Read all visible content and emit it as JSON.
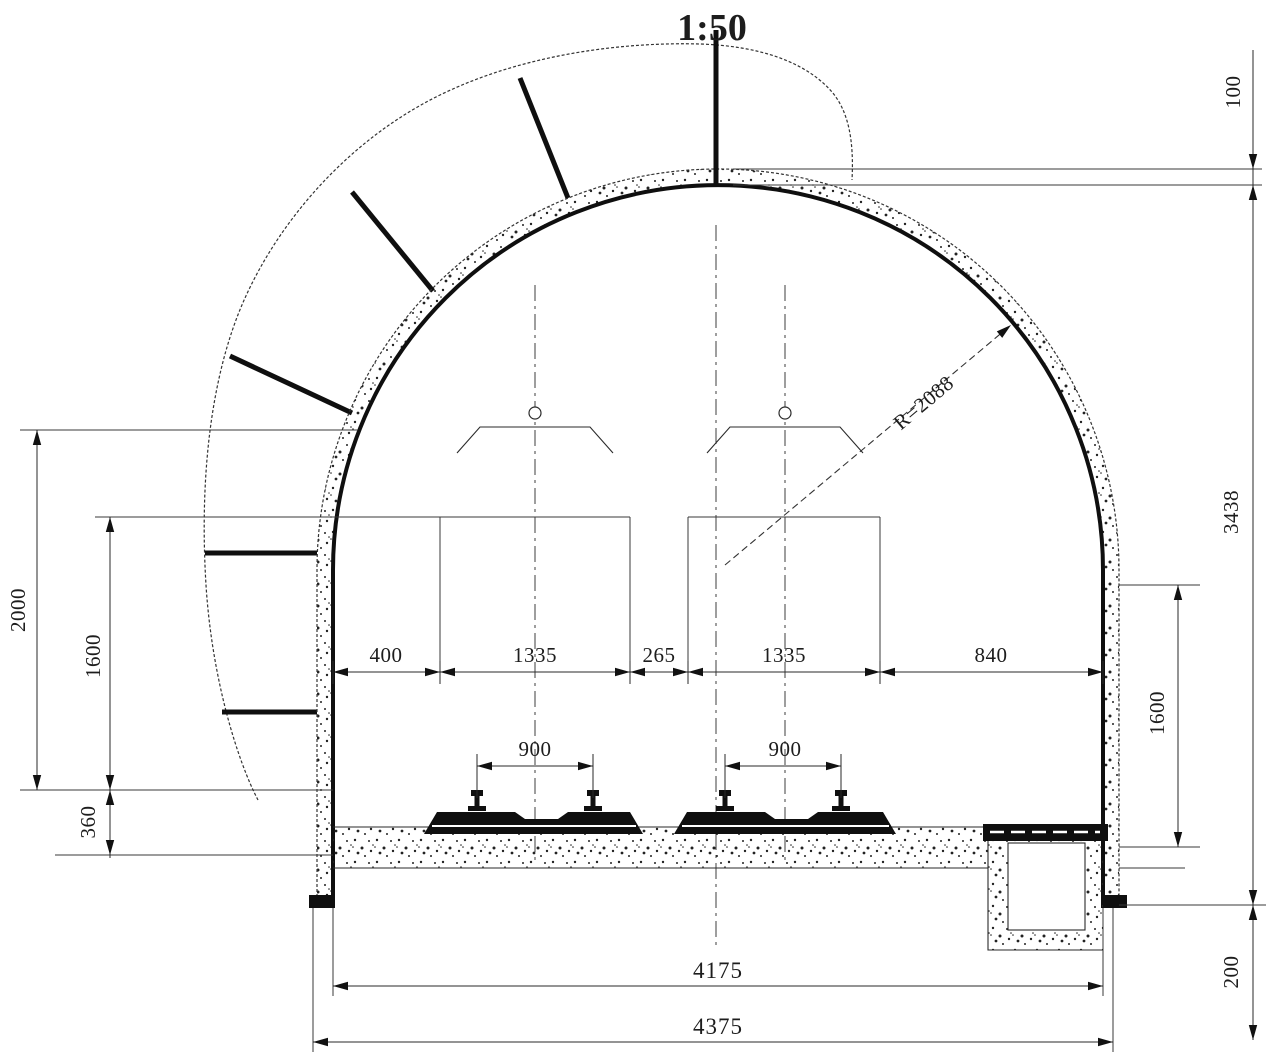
{
  "meta": {
    "scale": "1:50",
    "radius_label": "R=2088"
  },
  "dims": {
    "lining_thickness": "100",
    "total_height": "3438",
    "left_outer_height": "2000",
    "left_inner_height": "1600",
    "ballast_depth": "360",
    "chain": [
      "400",
      "1335",
      "265",
      "1335",
      "840"
    ],
    "gauge_left": "900",
    "gauge_right": "900",
    "right_lower_height": "1600",
    "ditch_depth": "200",
    "span_inner": "4175",
    "span_outer": "4375"
  }
}
